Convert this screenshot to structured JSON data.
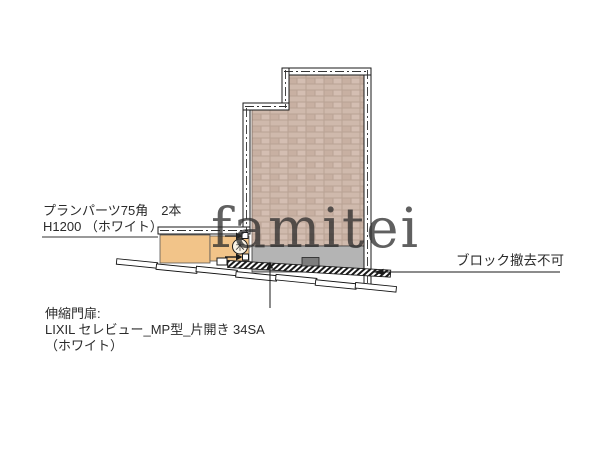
{
  "watermark": "famitei",
  "labels": {
    "plan_parts_line1": "プランパーツ75角　2本",
    "plan_parts_line2": "H1200 （ホワイト）",
    "block_note": "ブロック撤去不可",
    "gate_line1": "伸縮門扉:",
    "gate_line2": "LIXIL セレビュー_MP型_片開き 34SA",
    "gate_line3": "（ホワイト）"
  },
  "symbols": {
    "tree": "木"
  },
  "colors": {
    "background": "#ffffff",
    "line": "#1a1a1a",
    "brick_mortar": "#b9a294",
    "brick": "#cfb9ac",
    "brick_alt1": "#c8b0a2",
    "brick_alt2": "#d4beb2",
    "block_gray": "#b4b4b4",
    "fence_orange": "#f2c489",
    "dark_block": "#7d7d7d",
    "watermark_gray": "#d2d2d2"
  }
}
